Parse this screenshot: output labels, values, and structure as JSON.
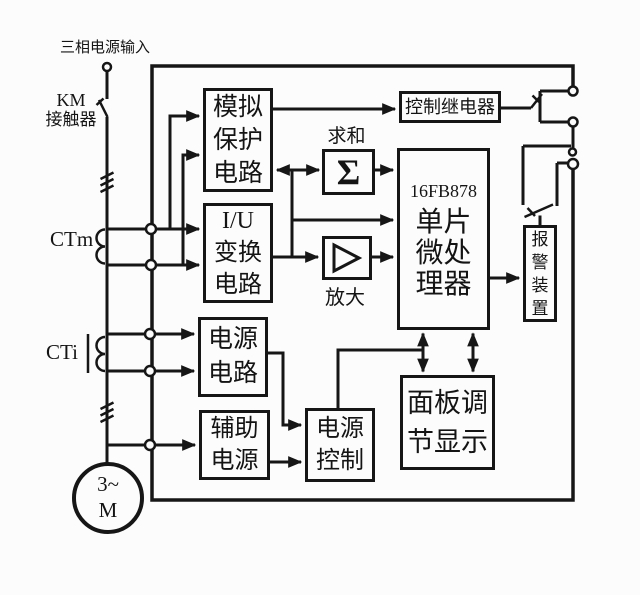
{
  "colors": {
    "line": "#161616",
    "background": "#fcfcfc"
  },
  "labels": {
    "power_input": "三相电源输入",
    "km_line1": "KM",
    "km_line2": "接触器",
    "ct_m": "CTm",
    "ct_i": "CTi",
    "sum_caption": "求和",
    "amp_caption": "放大",
    "motor_line1": "3~",
    "motor_line2": "M"
  },
  "blocks": {
    "analog_protection": {
      "lines": [
        "模拟",
        "保护",
        "电路"
      ]
    },
    "iu_converter": {
      "lines": [
        "I/U",
        "变换",
        "电路"
      ]
    },
    "power_circuit": {
      "lines": [
        "电源",
        "电路"
      ]
    },
    "aux_power": {
      "lines": [
        "辅助",
        "电源"
      ]
    },
    "power_control": {
      "lines": [
        "电源",
        "控制"
      ]
    },
    "panel_display": {
      "lines": [
        "面板调",
        "节显示"
      ]
    },
    "control_relay": {
      "label": "控制继电器"
    },
    "microprocessor": {
      "chip": "16FB878",
      "lines": [
        "单片",
        "微处",
        "理器"
      ]
    },
    "alarm": {
      "chars": [
        "报",
        "警",
        "装",
        "置"
      ]
    },
    "summator": {
      "symbol": "Σ"
    }
  },
  "icons": {
    "summation": "Σ",
    "amplifier": "triangle-right",
    "motor": "circle-3~M"
  }
}
